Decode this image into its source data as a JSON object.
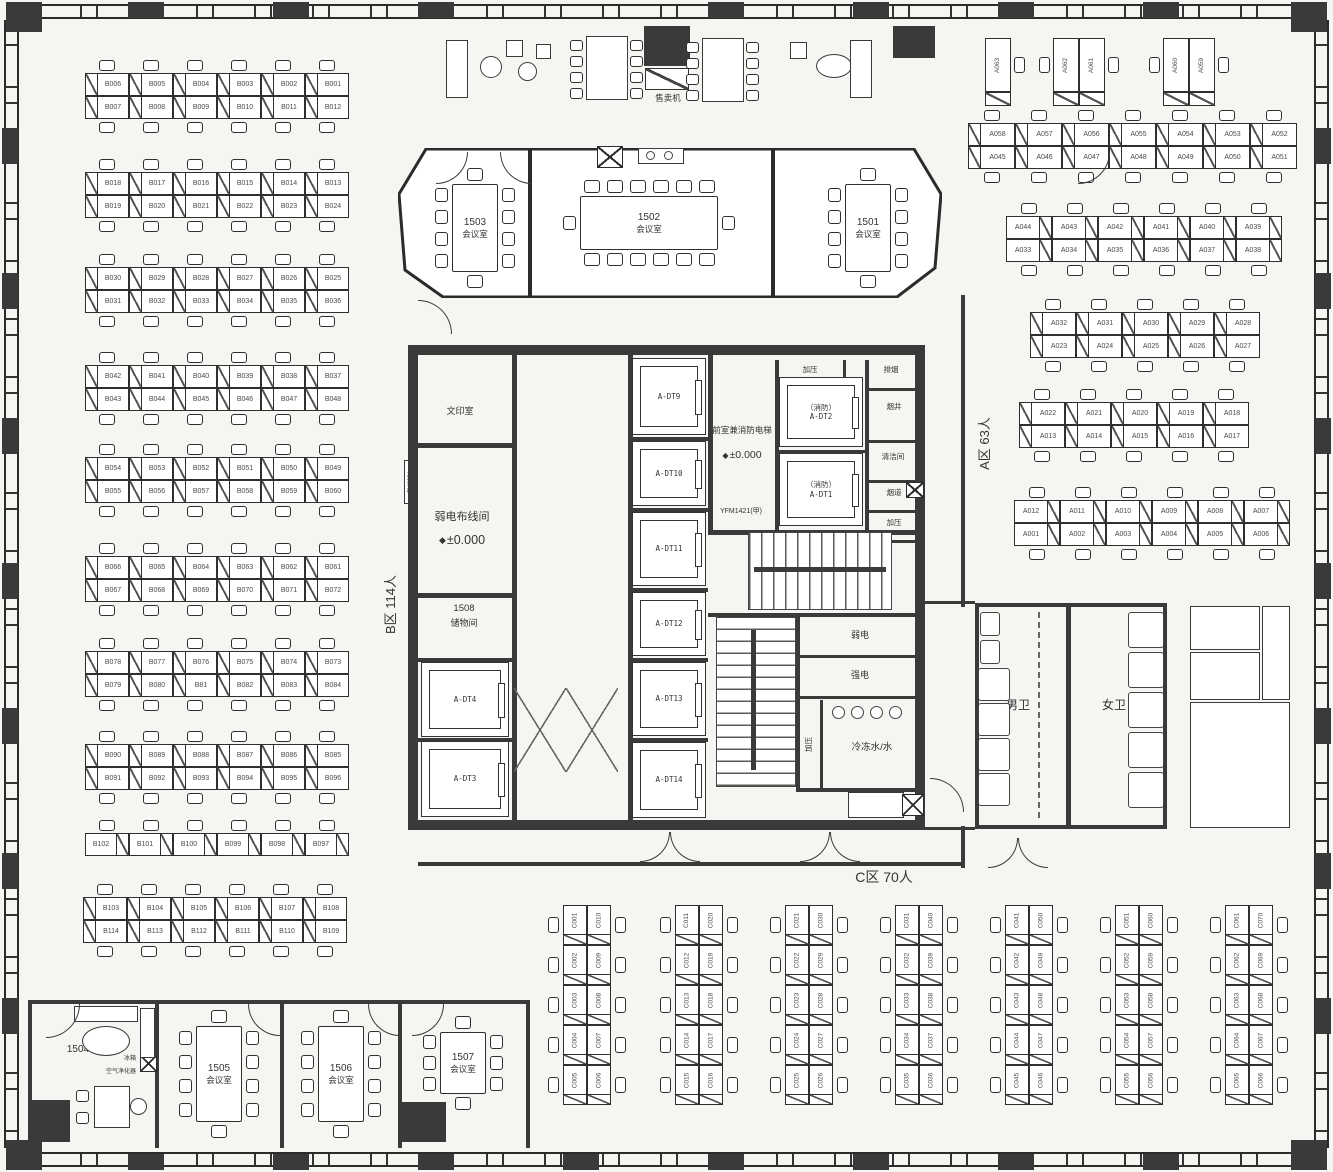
{
  "plan": {
    "zone_labels": {
      "a": "A区 63人",
      "b": "B区 114人",
      "c": "C区 70人"
    },
    "desks": {
      "b_rows": [
        {
          "top": [
            "B006",
            "B005",
            "B004",
            "B003",
            "B002",
            "B001"
          ],
          "bottom": [
            "B007",
            "B008",
            "B009",
            "B010",
            "B011",
            "B012"
          ]
        },
        {
          "top": [
            "B018",
            "B017",
            "B016",
            "B015",
            "B014",
            "B013"
          ],
          "bottom": [
            "B019",
            "B020",
            "B021",
            "B022",
            "B023",
            "B024"
          ]
        },
        {
          "top": [
            "B030",
            "B029",
            "B028",
            "B027",
            "B026",
            "B025"
          ],
          "bottom": [
            "B031",
            "B032",
            "B033",
            "B034",
            "B035",
            "B036"
          ]
        },
        {
          "top": [
            "B042",
            "B041",
            "B040",
            "B039",
            "B038",
            "B037"
          ],
          "bottom": [
            "B043",
            "B044",
            "B045",
            "B046",
            "B047",
            "B048"
          ]
        },
        {
          "top": [
            "B054",
            "B053",
            "B052",
            "B051",
            "B050",
            "B049"
          ],
          "bottom": [
            "B055",
            "B056",
            "B057",
            "B058",
            "B059",
            "B060"
          ]
        },
        {
          "top": [
            "B066",
            "B065",
            "B064",
            "B063",
            "B062",
            "B061"
          ],
          "bottom": [
            "B067",
            "B068",
            "B069",
            "B070",
            "B071",
            "B072"
          ]
        },
        {
          "top": [
            "B078",
            "B077",
            "B076",
            "B075",
            "B074",
            "B073"
          ],
          "bottom": [
            "B079",
            "B080",
            "B81",
            "B082",
            "B083",
            "B084"
          ]
        },
        {
          "top": [
            "B090",
            "B089",
            "B088",
            "B087",
            "B086",
            "B085"
          ],
          "bottom": [
            "B091",
            "B092",
            "B093",
            "B094",
            "B095",
            "B096"
          ]
        },
        {
          "row": [
            "B102",
            "B101",
            "B100",
            "B099",
            "B098",
            "B097"
          ]
        },
        {
          "top": [
            "B103",
            "B104",
            "B105",
            "B106",
            "B107",
            "B108"
          ],
          "bottom": [
            "B114",
            "B113",
            "B112",
            "B111",
            "B110",
            "B109"
          ]
        }
      ],
      "a_mini": [
        [
          "A063"
        ],
        [
          "A062",
          "A061"
        ],
        [
          "A060",
          "A059"
        ]
      ],
      "a_rows": [
        {
          "top": [
            "A058",
            "A057",
            "A056",
            "A055",
            "A054",
            "A053",
            "A052"
          ],
          "bottom": [
            "A045",
            "A046",
            "A047",
            "A048",
            "A049",
            "A050",
            "A051"
          ]
        },
        {
          "top": [
            "A044",
            "A043",
            "A042",
            "A041",
            "A040",
            "A039"
          ],
          "bottom": [
            "A033",
            "A034",
            "A035",
            "A036",
            "A037",
            "A038"
          ]
        },
        {
          "top": [
            "A032",
            "A031",
            "A030",
            "A029",
            "A028"
          ],
          "bottom": [
            "A023",
            "A024",
            "A025",
            "A026",
            "A027"
          ]
        },
        {
          "top": [
            "A022",
            "A021",
            "A020",
            "A019",
            "A018"
          ],
          "bottom": [
            "A013",
            "A014",
            "A015",
            "A016",
            "A017"
          ]
        },
        {
          "top": [
            "A012",
            "A011",
            "A010",
            "A009",
            "A008",
            "A007"
          ],
          "bottom": [
            "A001",
            "A002",
            "A003",
            "A004",
            "A005",
            "A006"
          ]
        }
      ],
      "c_cols": [
        {
          "left": [
            "C001",
            "C002",
            "C003",
            "C004",
            "C005"
          ],
          "right": [
            "C010",
            "C009",
            "C008",
            "C007",
            "C006"
          ]
        },
        {
          "left": [
            "C011",
            "C012",
            "C013",
            "C014",
            "C015"
          ],
          "right": [
            "C020",
            "C019",
            "C018",
            "C017",
            "C016"
          ]
        },
        {
          "left": [
            "C021",
            "C022",
            "C023",
            "C024",
            "C025"
          ],
          "right": [
            "C030",
            "C029",
            "C028",
            "C027",
            "C026"
          ]
        },
        {
          "left": [
            "C031",
            "C032",
            "C033",
            "C034",
            "C035"
          ],
          "right": [
            "C040",
            "C039",
            "C038",
            "C037",
            "C036"
          ]
        },
        {
          "left": [
            "C041",
            "C042",
            "C043",
            "C044",
            "C045"
          ],
          "right": [
            "C050",
            "C049",
            "C048",
            "C047",
            "C046"
          ]
        },
        {
          "left": [
            "C051",
            "C052",
            "C053",
            "C054",
            "C055"
          ],
          "right": [
            "C060",
            "C059",
            "C058",
            "C057",
            "C056"
          ]
        },
        {
          "left": [
            "C061",
            "C062",
            "C063",
            "C064",
            "C065"
          ],
          "right": [
            "C070",
            "C069",
            "C068",
            "C067",
            "C066"
          ]
        }
      ]
    },
    "meeting_rooms": [
      {
        "id": "1503",
        "type_label": "会议室"
      },
      {
        "id": "1502",
        "type_label": "会议室"
      },
      {
        "id": "1501",
        "type_label": "会议室"
      },
      {
        "id": "1504",
        "type_label": ""
      },
      {
        "id": "1505",
        "type_label": "会议室"
      },
      {
        "id": "1506",
        "type_label": "会议室"
      },
      {
        "id": "1507",
        "type_label": "会议室"
      }
    ],
    "core": {
      "print_room": "文印室",
      "lv_room_name": "弱电布线间",
      "lv_level": "±0.000",
      "level_marker": "◆",
      "lv_door_tag": "FM3921",
      "storage_id": "1508",
      "storage_name": "储物间",
      "left_elevators": [
        "A-DT4",
        "A-DT3"
      ],
      "right_elevators": [
        "A-DT9",
        "A-DT10",
        "A-DT11",
        "A-DT12",
        "A-DT13",
        "A-DT14"
      ],
      "fire_lobby_name": "前室兼消防电梯",
      "fire_lobby_level": "±0.000",
      "fire_lobby_door_tag": "YFM1421(甲)",
      "fire_elevators": [
        {
          "tag": "（消防）",
          "id": "A-DT2"
        },
        {
          "tag": "（消防）",
          "id": "A-DT1"
        }
      ],
      "shaft_top_left": "加压",
      "shaft_top_right": "排烟",
      "shaft_right": [
        "烟井",
        "清洁间",
        "烟道",
        "加压"
      ],
      "stair_up": "上",
      "stair_down": "下",
      "weak_power": "弱电",
      "strong_power": "强电",
      "pressure_room": "加压",
      "chilled_water": "冷冻水/水",
      "smoke_box": "排烟"
    },
    "facilities": {
      "mens": "男卫",
      "womens": "女卫",
      "exhaust_shaft": "排风井",
      "pipe_shaft": "水管井",
      "intake_shaft": "进风井",
      "fresh_air_room": "新风机房"
    },
    "furniture": {
      "vending": "售卖机",
      "air_purifier": "空气净化器",
      "fridge": "冰箱"
    }
  }
}
